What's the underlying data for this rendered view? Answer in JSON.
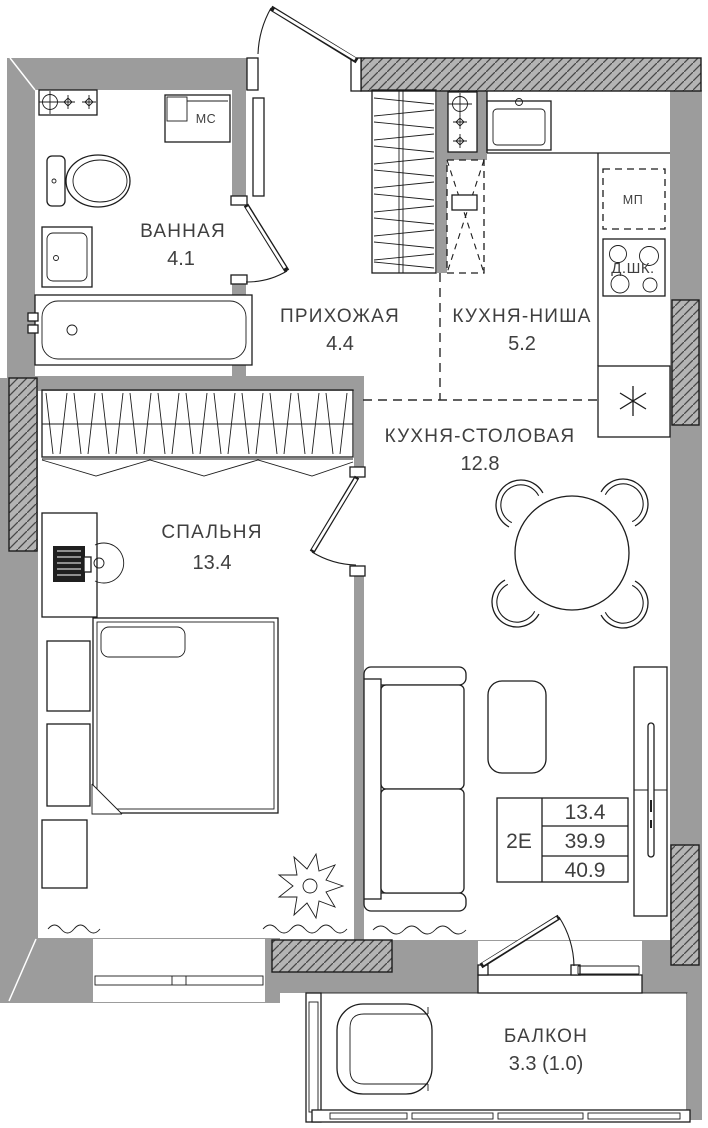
{
  "plan": {
    "rooms": [
      {
        "name": "ВАННАЯ",
        "area": "4.1"
      },
      {
        "name": "ПРИХОЖАЯ",
        "area": "4.4"
      },
      {
        "name": "КУХНЯ-НИША",
        "area": "5.2"
      },
      {
        "name": "КУХНЯ-СТОЛОВАЯ",
        "area": "12.8"
      },
      {
        "name": "СПАЛЬНЯ",
        "area": "13.4"
      },
      {
        "name": "БАЛКОН",
        "area": "3.3 (1.0)"
      }
    ],
    "labels": {
      "washing_machine": "МС",
      "microwave_place": "МП",
      "oven": "Д.ШК."
    },
    "summary": {
      "type": "2Е",
      "bedroom_area": "13.4",
      "area_without_balcony": "39.9",
      "total_area": "40.9"
    },
    "colors": {
      "wall": "#9c9c9c",
      "hatch_fill": "#b4b4b4",
      "hatch_line": "#474747",
      "line": "#1c1c1c",
      "text": "#3f3f3f",
      "background": "#ffffff"
    }
  }
}
